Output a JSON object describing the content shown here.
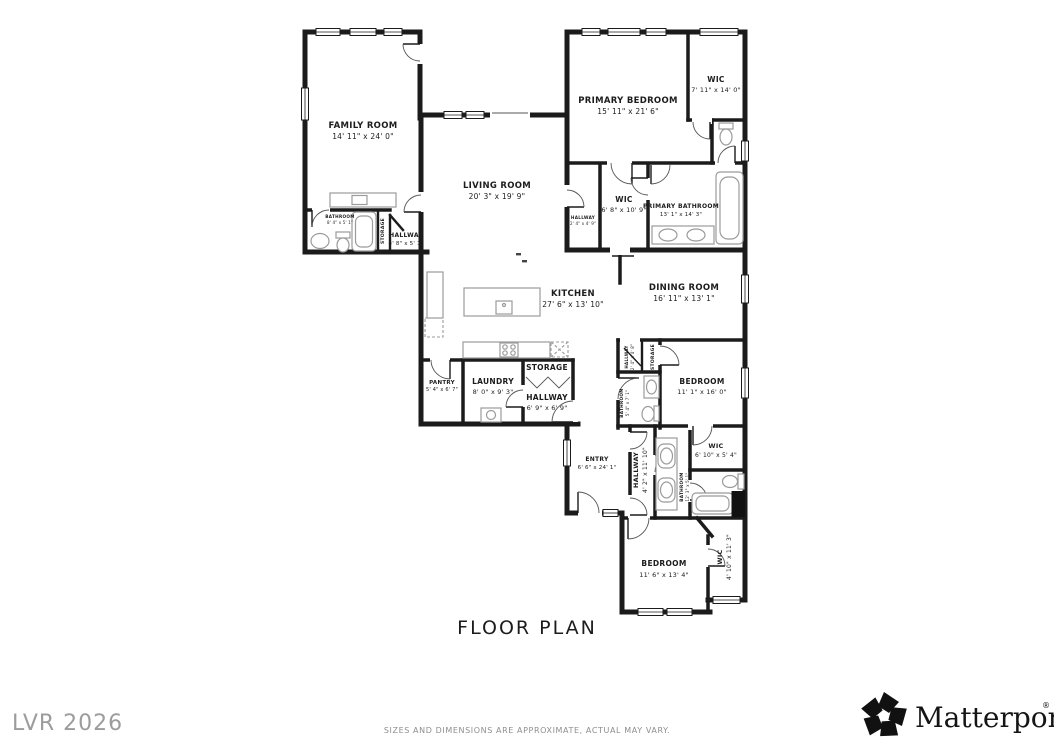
{
  "title": "FLOOR PLAN",
  "disclaimer": "SIZES AND DIMENSIONS ARE APPROXIMATE, ACTUAL MAY VARY.",
  "watermark": "LVR 2026",
  "brand": {
    "name": "Matterport",
    "reg": "®"
  },
  "colors": {
    "wall": "#1b1b1b",
    "fixture": "#9b9b9b",
    "label": "#1c1c1c",
    "muted": "#8e8e8e"
  },
  "rooms": {
    "family_room": {
      "name": "FAMILY ROOM",
      "dims": "14' 11\" x 24' 0\""
    },
    "living_room": {
      "name": "LIVING ROOM",
      "dims": "20' 3\" x 19' 9\""
    },
    "primary_bedroom": {
      "name": "PRIMARY BEDROOM",
      "dims": "15' 11\" x 21' 6\""
    },
    "wic_top": {
      "name": "WIC",
      "dims": "7' 11\" x 14' 0\""
    },
    "wic_primary": {
      "name": "WIC",
      "dims": "6' 8\" x 10' 9\""
    },
    "primary_bathroom": {
      "name": "PRIMARY BATHROOM",
      "dims": "13' 1\" x 14' 3\""
    },
    "hallway_primary": {
      "name": "HALLWAY",
      "dims": "2' 4\" x 4' 9\""
    },
    "bathroom_family": {
      "name": "BATHROOM",
      "dims": "8' 4\" x 5' 1\""
    },
    "storage_family": {
      "name": "STORAGE",
      "dims": ""
    },
    "hallway_family": {
      "name": "HALLWAY",
      "dims": "4' 8\" x 5' 1\""
    },
    "kitchen": {
      "name": "KITCHEN",
      "dims": "27' 6\" x 13' 10\""
    },
    "dining_room": {
      "name": "DINING ROOM",
      "dims": "16' 11\" x 13' 1\""
    },
    "pantry": {
      "name": "PANTRY",
      "dims": "5' 4\" x 6' 7\""
    },
    "laundry": {
      "name": "LAUNDRY",
      "dims": "8' 0\" x 9' 3\""
    },
    "storage_hall": {
      "name": "STORAGE",
      "dims": ""
    },
    "hallway_main": {
      "name": "HALLWAY",
      "dims": "6' 9\" x 6' 9\""
    },
    "bedroom_mid": {
      "name": "BEDROOM",
      "dims": "11' 1\" x 16' 0\""
    },
    "storage_mid": {
      "name": "STORAGE",
      "dims": ""
    },
    "hallway_mid": {
      "name": "HALLWAY",
      "dims": "2' 4\" x 4' 8\""
    },
    "bathroom_mid": {
      "name": "BATHROOM",
      "dims": "5' 4\" x 7' 1\""
    },
    "entry": {
      "name": "ENTRY",
      "dims": "6' 6\" x 24' 1\""
    },
    "hallway_entry": {
      "name": "HALLWAY",
      "dims": "4' 2\" x 11' 10\""
    },
    "bathroom_entry": {
      "name": "BATHROOM",
      "dims": "12' 3\" x 5' 1\""
    },
    "wic_mid": {
      "name": "WIC",
      "dims": "6' 10\" x 5' 4\""
    },
    "bedroom_bottom": {
      "name": "BEDROOM",
      "dims": "11' 6\" x 13' 4\""
    },
    "wic_bottom": {
      "name": "WIC",
      "dims": "4' 10\" x 11' 3\""
    }
  }
}
